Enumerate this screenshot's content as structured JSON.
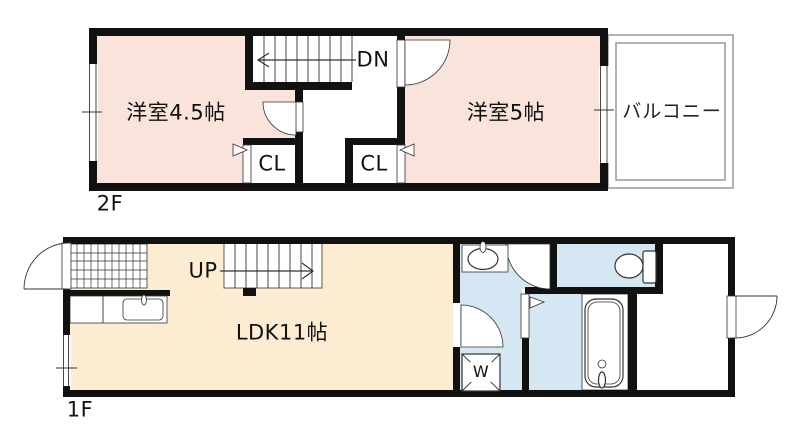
{
  "floor2": {
    "label": "2F",
    "room_left": "洋室4.5帖",
    "room_right": "洋室5帖",
    "stairs": "DN",
    "closet_left": "CL",
    "closet_right": "CL",
    "balcony": "バルコニー"
  },
  "floor1": {
    "label": "1F",
    "living": "LDK11帖",
    "stairs": "UP",
    "washer": "W"
  },
  "colors": {
    "wall": "#111111",
    "room_pink": "#f9e3da",
    "room_beige": "#fcecd1",
    "wet_blue": "#d5e7f3",
    "balcony_line": "#999999",
    "line": "#333333"
  }
}
